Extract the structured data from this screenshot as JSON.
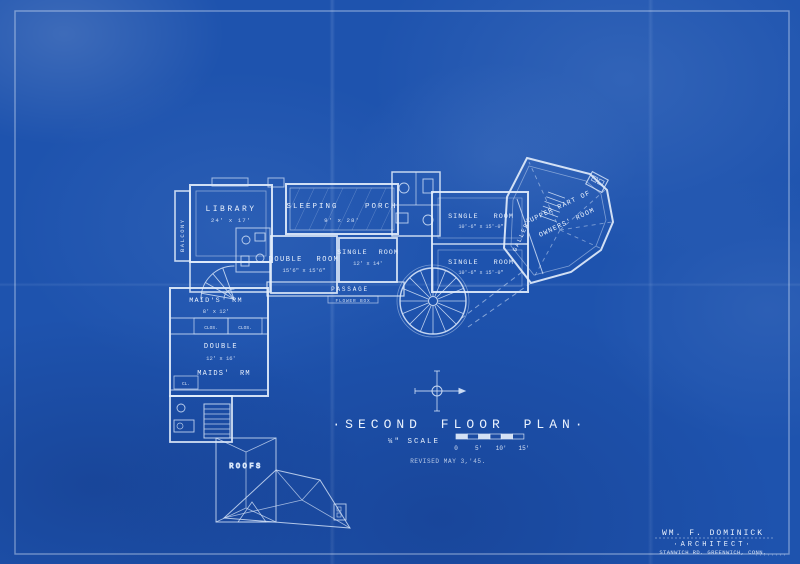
{
  "sheet": {
    "title": "·SECOND FLOOR PLAN·",
    "scale_label": "¼\" SCALE",
    "scale_ticks": [
      "0",
      "5'",
      "10'",
      "15'"
    ],
    "revised_note": "REVISED MAY 3,'45.",
    "colors": {
      "paper": "#1e53ae",
      "line": "#e8f1fd"
    }
  },
  "rooms": {
    "balcony": {
      "name": "BALCONY"
    },
    "library": {
      "name": "LIBRARY",
      "dims": "24' x 17'"
    },
    "sleeping_porch": {
      "name": "SLEEPING PORCH",
      "dims": "9' x 28'"
    },
    "double_room": {
      "name": "DOUBLE ROOM",
      "dims": "15'6\" x 15'6\""
    },
    "single_room_center": {
      "name": "SINGLE ROOM",
      "dims": "12' x 14'"
    },
    "single_room_upper": {
      "name": "SINGLE ROOM",
      "dims": "10'-6\" x 15'-0\""
    },
    "single_room_lower": {
      "name": "SINGLE ROOM",
      "dims": "10'-6\" x 15'-0\""
    },
    "gallery": {
      "name": "GALLERY"
    },
    "owners_room": {
      "line1": "UPPER PART OF",
      "line2": "OWNERS' ROOM"
    },
    "passage": {
      "name": "PASSAGE",
      "note": "FLOWER BOX"
    },
    "maids_room_upper": {
      "name": "MAID'S RM",
      "dims": "8' x 12'"
    },
    "double_maids_room": {
      "name": "DOUBLE",
      "dims": "12' x 16'",
      "name2": "MAIDS' RM"
    },
    "closet_left": {
      "name": "CLOS."
    },
    "closet_right": {
      "name": "CLOS."
    },
    "closet_small": {
      "name": "CL."
    },
    "roofs": {
      "name": "ROOFS"
    }
  },
  "stamp": {
    "architect_name": "WM. F. DOMINICK",
    "architect_title": "·ARCHITECT·",
    "architect_address": "STANWICH RD. GREENWICH, CONN."
  }
}
